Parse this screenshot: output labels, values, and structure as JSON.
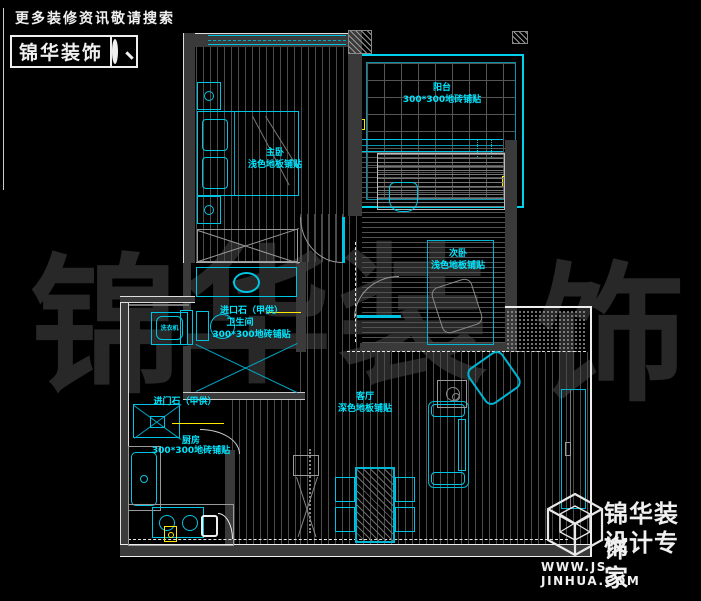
{
  "header": {
    "tagline": "更多装修资讯敬请搜索",
    "brand": "锦华装饰"
  },
  "watermark": [
    "锦",
    "华",
    "装",
    "饰"
  ],
  "rooms": {
    "master": {
      "name": "主卧",
      "finish": "浅色地板铺贴"
    },
    "balcony": {
      "name": "阳台",
      "finish": "300*300地砖铺贴"
    },
    "bedroom2": {
      "name": "次卧",
      "finish": "浅色地板铺贴"
    },
    "bathroom": {
      "stone": "进口石（甲供）",
      "name": "卫生间",
      "finish": "300*300地砖铺贴"
    },
    "kitchen": {
      "stone": "进门石（甲供）",
      "name": "厨房",
      "finish": "300*300地砖铺贴"
    },
    "living": {
      "name": "客厅",
      "finish": "深色地板铺贴"
    },
    "laundry": {
      "washer": "洗衣机"
    }
  },
  "footer": {
    "brand_line1": "锦华装饰",
    "brand_line2": "设计专家",
    "website": "WWW.JS-JINHUA.COM"
  },
  "colors": {
    "background": "#000000",
    "line_cyan": "#00c4e4",
    "label_cyan": "#00e6ff",
    "accent_yellow": "#ffe900",
    "wall_gray": "#3a3a3a",
    "watermark_gray": "#282828"
  }
}
